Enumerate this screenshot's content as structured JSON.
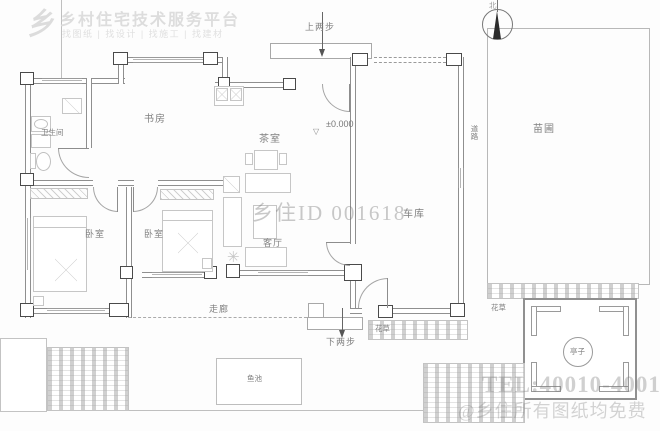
{
  "watermarks": {
    "logo_mark": "乡",
    "logo_title": "乡村住宅技术服务平台",
    "logo_subtitle": "找图纸 | 找设计 | 找施工 | 找建材",
    "center_id": "乡住ID 001618",
    "tel": "TEL:40010-40010",
    "footer": "@乡住所有图纸均免费"
  },
  "compass": {
    "north": "北"
  },
  "rooms": {
    "bathroom": "卫生间",
    "study": "书房",
    "tea_room": "茶室",
    "bedroom_left": "卧室",
    "bedroom_right": "卧室",
    "living_room": "客厅",
    "corridor": "走廊",
    "garage": "车库"
  },
  "site": {
    "nursery": "苗圃",
    "road": "道路",
    "flowers_south": "花草",
    "flowers_east": "花草",
    "pavilion": "亭子",
    "fish_pond": "鱼池"
  },
  "annotations": {
    "steps_up": "上两步",
    "steps_down": "下两步",
    "level": "±0.000",
    "level_symbol": "▽"
  },
  "colors": {
    "wall": "#8f8f8f",
    "column_border": "#4a4a4a",
    "label": "#808080",
    "furniture": "#c6c6c6",
    "hatch": "#bdbdbd",
    "watermark": "#d7d7d7"
  }
}
